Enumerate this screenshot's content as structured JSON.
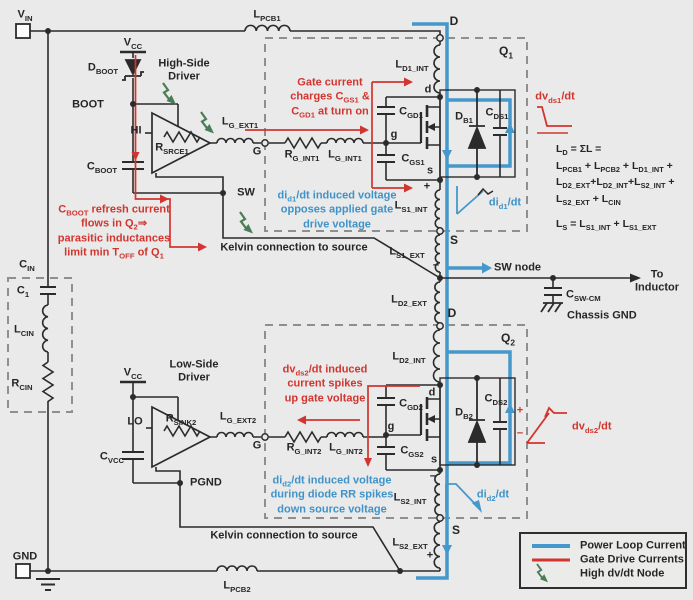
{
  "title": "Half-bridge gate-drive parasitic inductance schematic",
  "colors": {
    "background": "#e9eae9",
    "wire": "#2b2b2b",
    "power_loop": "#4598cb",
    "gate_drive": "#d2352f",
    "high_dvdt_node": "#4a7c55",
    "dashed_box": "#8f8f8f"
  },
  "labels": {
    "vin": "V_{IN}",
    "gnd": "GND",
    "vcc_hs": "V_{CC}",
    "vcc_ls": "V_{CC}",
    "dboot": "D_{BOOT}",
    "boot": "BOOT",
    "hi": "HI",
    "lo": "LO",
    "rsrce1": "R_{SRCE1}",
    "rsink2": "R_{SINK2}",
    "cboot": "C_{BOOT}",
    "cvcc": "C_{VCC}",
    "sw": "SW",
    "pgnd": "PGND",
    "hs_driver": "High-Side\nDriver",
    "ls_driver": "Low-Side\nDriver",
    "lpcb1": "L_{PCB1}",
    "lpcb2": "L_{PCB2}",
    "lgext1": "L_{G_EXT1}",
    "rgint1": "R_{G_INT1}",
    "lgint1": "L_{G_INT1}",
    "lgext2": "L_{G_EXT2}",
    "rgint2": "R_{G_INT2}",
    "lgint2": "L_{G_INT2}",
    "g_hs": "G",
    "g_ls": "G",
    "ld1int": "L_{D1_INT}",
    "ld2int": "L_{D2_INT}",
    "ld2ext": "L_{D2_EXT}",
    "ls1int": "L_{S1_INT}",
    "ls1ext": "L_{S1_EXT}",
    "ls2int": "L_{S2_INT}",
    "ls2ext": "L_{S2_EXT}",
    "q1": "Q_{1}",
    "q2": "Q_{2}",
    "d_node_top": "D",
    "d_node_mid": "D",
    "s_node_q1": "S",
    "s_node_q2": "S",
    "q1_d": "d",
    "q1_g": "g",
    "q1_s": "s",
    "q2_d": "d",
    "q2_g": "g",
    "q2_s": "s",
    "cgd1": "C_{GD1}",
    "cgs1": "C_{GS1}",
    "cds1": "C_{DS1}",
    "db1": "D_{B1}",
    "cgd2": "C_{GD2}",
    "cgs2": "C_{GS2}",
    "cds2": "C_{DS2}",
    "db2": "D_{B2}",
    "cin": "C_{IN}",
    "c1": "C_{1}",
    "lcin": "L_{CIN}",
    "rcin": "R_{CIN}",
    "cswcm": "C_{SW-CM}",
    "chassis_gnd": "Chassis GND",
    "sw_node": "SW node",
    "to_inductor": "To\nInductor",
    "kelvin_top": "Kelvin connection to source",
    "kelvin_bottom": "Kelvin connection to source",
    "plus_q1": "+",
    "minus_q1": "−",
    "minus_q2": "−",
    "plus_q2": "+",
    "plus_cds2": "+",
    "minus_cds2": "−"
  },
  "annotations": {
    "gate_charge": "Gate current\ncharges C_{GS1} &\nC_{GD1} at turn on",
    "cboot_refresh": "C_{BOOT} refresh current\nflows in Q_{2}⇒\nparasitic inductances\nlimit min T_{OFF} of Q_{1}",
    "did1_induced": "di_{d1}/dt induced voltage\nopposes applied gate\ndrive voltage",
    "dvds2_induced": "dv_{ds2}/dt induced\ncurrent spikes\nup gate voltage",
    "did2_induced": "di_{d2}/dt induced voltage\nduring diode RR spikes\ndown source voltage"
  },
  "waveform_labels": {
    "dvds1": "dv_{ds1}/dt",
    "did1": "di_{d1}/dt",
    "dvds2": "dv_{ds2}/dt",
    "did2": "di_{d2}/dt"
  },
  "equations": {
    "ld": "L_{D} = ΣL =\nL_{PCB1} + L_{PCB2} + L_{D1_INT} +\nL_{D2_EXT}+L_{D2_INT}+L_{S2_INT} +\nL_{S2_EXT} + L_{CIN}",
    "ls": "L_{S} = L_{S1_INT} + L_{S1_EXT}"
  },
  "legend": {
    "items": [
      {
        "name": "power-loop-current",
        "label": "Power Loop Current",
        "color": "#4598cb"
      },
      {
        "name": "gate-drive-currents",
        "label": "Gate Drive Currents",
        "color": "#d2352f"
      },
      {
        "name": "high-dvdt-node",
        "label": "High dv/dt Node",
        "color": "#4a7c55"
      }
    ]
  }
}
